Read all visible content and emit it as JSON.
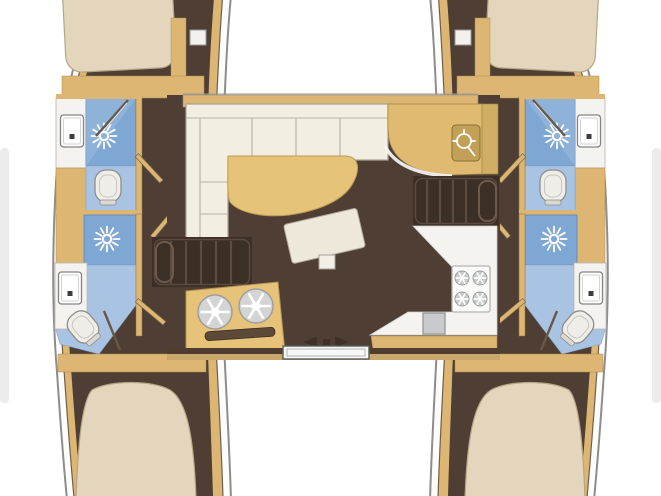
{
  "meta": {
    "description": "Top-down interior floor plan of a 4-cabin catamaran: two hulls each with fore/aft double berths and two bathrooms (shower, toilet, sink), central salon with L-sofa, dining table, chart desk with helm icon, twin companionway stairs, galley with round sinks and 4-burner stove, aft sliding door."
  },
  "icons": {
    "shower": "sun-burst-icon",
    "helm": "ship-wheel-icon",
    "burner": "ring-star-icon",
    "round_sink": "ring-star-icon",
    "sliding_door": "left-right-arrows-icon",
    "deck_hatch": "white-square-icon"
  },
  "colors": {
    "background": "#ffffff",
    "deck_white": "#fcfcfb",
    "hull_outline": "#8d8d8d",
    "wood_trim": "#dcb672",
    "wood_edge": "#a98c52",
    "floor": "#4e3e33",
    "stairs": "#3b2f26",
    "step_line": "#5d4c3e",
    "bed": "#e4d6bc",
    "bed_edge": "#b7a685",
    "sofa": "#f3eee2",
    "sofa_edge": "#aaa294",
    "sofa_line": "#b9b1a1",
    "table": "#e7c379",
    "table_edge": "#bd9b55",
    "desk": "#e0ba70",
    "locker": "#d2ad66",
    "shower_tile": "#7fa7d3",
    "shower_light": "#9cbbde",
    "bath_floor": "#a9c3e2",
    "fixture": "#efede7",
    "fixture_edge": "#8e8e8e",
    "counter_white": "#f4f3f0",
    "appliance_gray": "#c9cacb",
    "appliance_edge": "#9b9c9e",
    "helm_panel": "#c2a058",
    "door_white": "#f7f7f7",
    "arrow_brown": "#3f3127",
    "aft_band_dark": "#4f3e30",
    "aft_band_tan": "#c9a76a",
    "mat": "#eee8da",
    "slot_dark": "#5d4938",
    "scan_artifact": "#e2e2e2",
    "icon_white": "#ffffff"
  }
}
